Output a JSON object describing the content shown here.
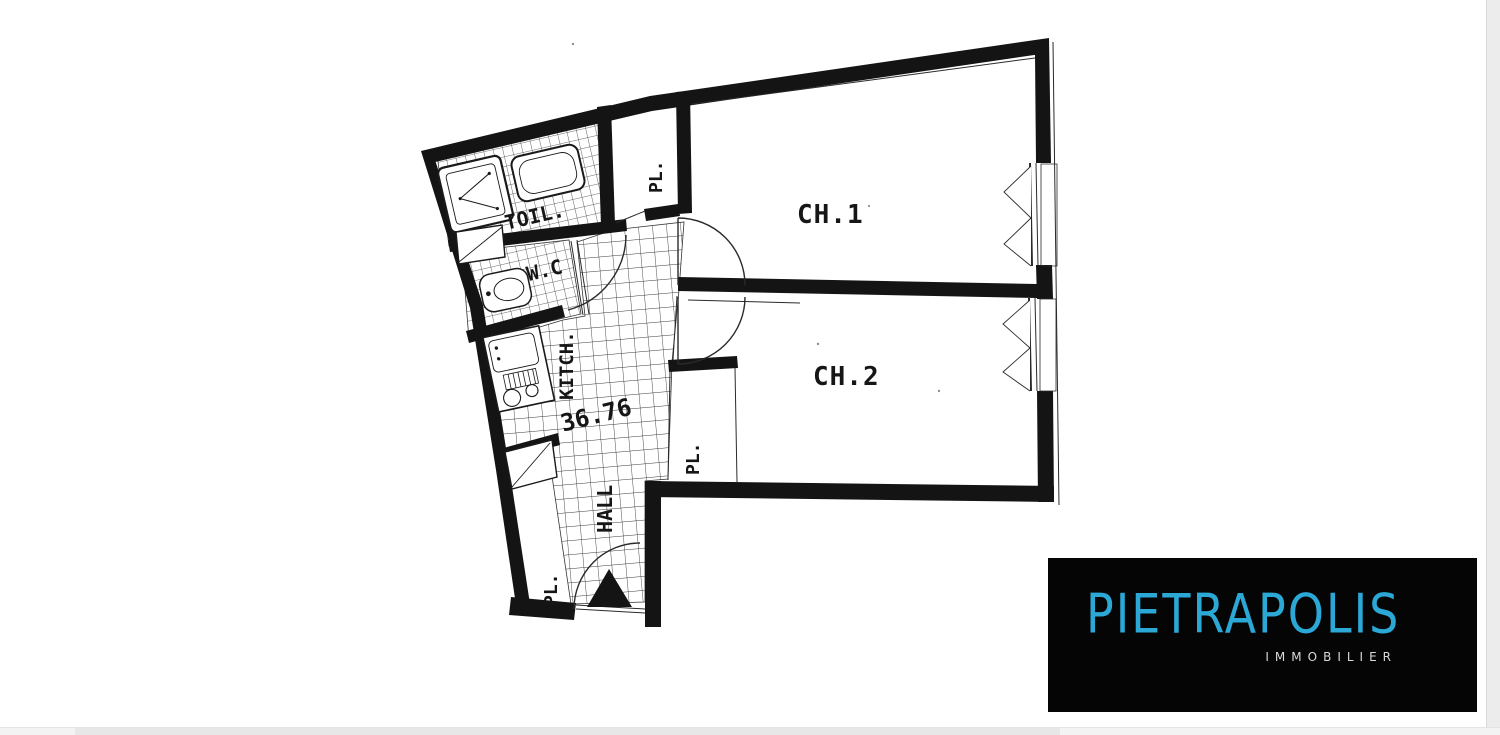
{
  "page": {
    "background": "#FFFFFF"
  },
  "floor_plan": {
    "ink_color": "#141414",
    "labels": {
      "bedroom1": "CH.1",
      "bedroom2": "CH.2",
      "bathroom": "TOIL.",
      "wc": "W.C",
      "kitchen": "KITCH.",
      "hall": "HALL",
      "area": "36.76",
      "closet_top": "PL.",
      "closet_bedroom2": "PL.",
      "closet_entry": "PL."
    }
  },
  "logo": {
    "brand": "PIETRAPOLIS",
    "tagline": "IMMOBILIER",
    "background": "#050505",
    "brand_color": "#2BA8D6",
    "tagline_color": "#D8D8D8"
  },
  "scrollbars": {
    "right_track": "#ECECEC",
    "bottom_track": "#F3F3F3",
    "bottom_thumb": "#E7E7E7"
  }
}
